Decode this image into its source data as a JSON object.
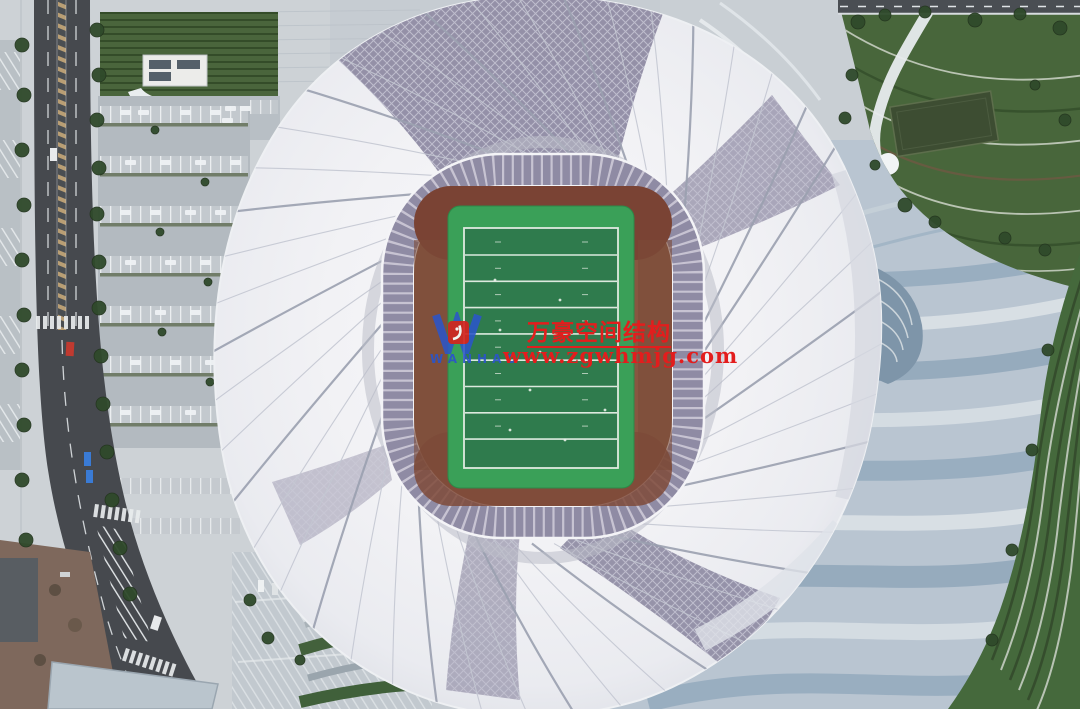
{
  "watermark": {
    "company_name": "万豪空间结构",
    "website": "www.zgwhmjg.com",
    "logo_text": "WANHAO"
  },
  "palette": {
    "wm-red": "#e31d1d",
    "wm-blue": "#2b55c9",
    "roof-white": "#f2f2f5",
    "glass-gray": "#8c88a1",
    "ring-gray": "#8f8ba4",
    "pitch-green": "#3aa058",
    "field-green": "#2f7b4d",
    "seats-brown": "#875741",
    "plaza-blue": "#b9c5d1",
    "park-green": "#48663b",
    "lawn-green": "#45693c",
    "road-gray": "#46494e"
  }
}
